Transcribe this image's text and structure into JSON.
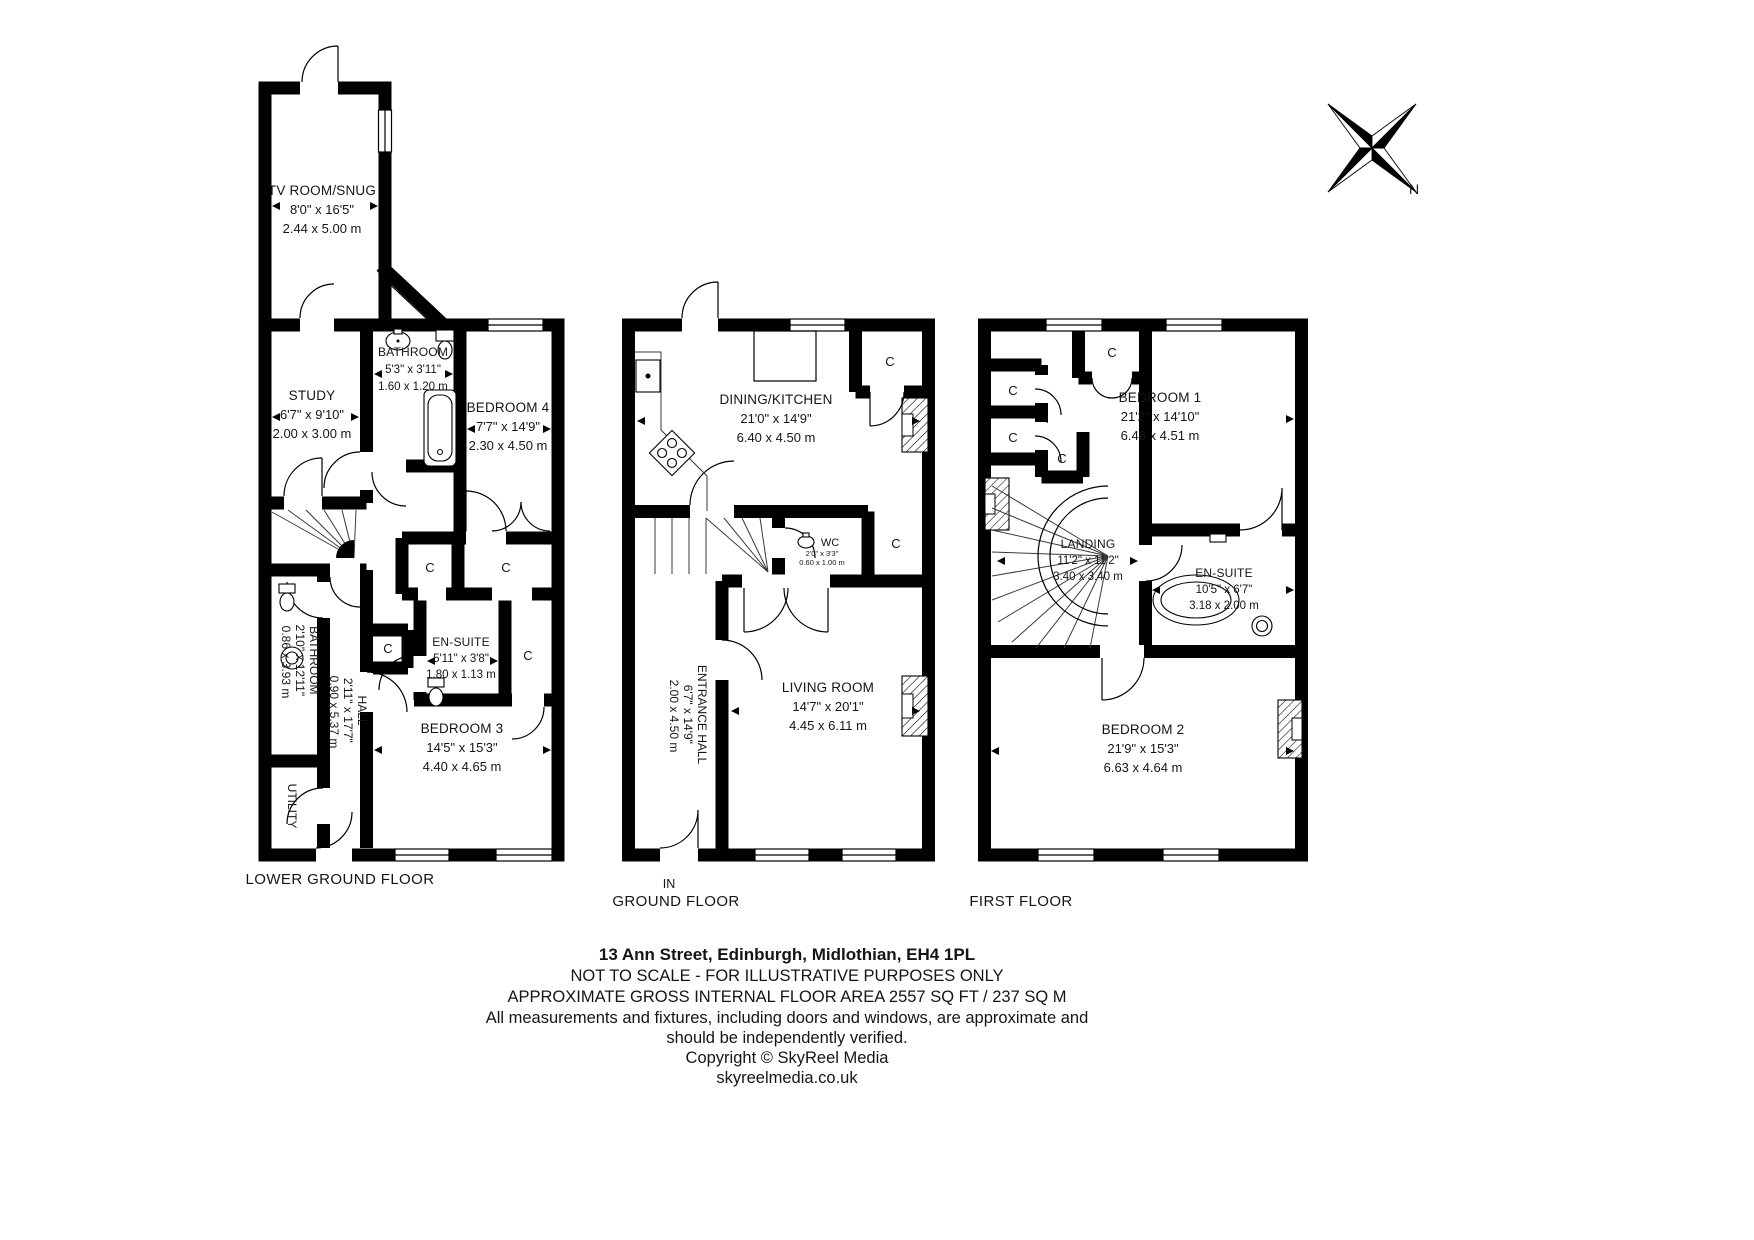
{
  "labels": {
    "closet": "C",
    "in": "IN",
    "north": "N"
  },
  "floors": {
    "lower": {
      "title": "LOWER GROUND FLOOR",
      "rooms": {
        "tv": {
          "name": "TV ROOM/SNUG",
          "imperial": "8'0\" x 16'5\"",
          "metric": "2.44 x 5.00 m"
        },
        "study": {
          "name": "STUDY",
          "imperial": "6'7\" x 9'10\"",
          "metric": "2.00 x 3.00 m"
        },
        "bathroom": {
          "name": "BATHROOM",
          "imperial": "5'3\" x 3'11\"",
          "metric": "1.60 x 1.20 m"
        },
        "bedroom4": {
          "name": "BEDROOM 4",
          "imperial": "7'7\" x 14'9\"",
          "metric": "2.30 x 4.50 m"
        },
        "ensuite": {
          "name": "EN-SUITE",
          "imperial": "5'11\" x 3'8\"",
          "metric": "1.80 x 1.13 m"
        },
        "bedroom3": {
          "name": "BEDROOM 3",
          "imperial": "14'5\" x 15'3\"",
          "metric": "4.40 x 4.65 m"
        },
        "side_bath": {
          "name": "BATHROOM",
          "imperial": "2'10\" x 12'11\"",
          "metric": "0.86 x 3.93 m"
        },
        "hall": {
          "name": "HALL",
          "imperial": "2'11\" x 17'7\"",
          "metric": "0.90 x 5.37 m"
        },
        "utility": {
          "name": "UTILITY"
        }
      }
    },
    "ground": {
      "title": "GROUND FLOOR",
      "rooms": {
        "dining": {
          "name": "DINING/KITCHEN",
          "imperial": "21'0\" x 14'9\"",
          "metric": "6.40 x 4.50 m"
        },
        "wc": {
          "name": "WC",
          "imperial": "2'0\" x 3'3\"",
          "metric": "0.60 x 1.00 m"
        },
        "living": {
          "name": "LIVING ROOM",
          "imperial": "14'7\" x 20'1\"",
          "metric": "4.45 x 6.11 m"
        },
        "entrance": {
          "name": "ENTRANCE HALL",
          "imperial": "6'7\" x 14'9\"",
          "metric": "2.00 x 4.50 m"
        }
      }
    },
    "first": {
      "title": "FIRST FLOOR",
      "rooms": {
        "bedroom1": {
          "name": "BEDROOM 1",
          "imperial": "21'2\" x 14'10\"",
          "metric": "6.46 x 4.51 m"
        },
        "landing": {
          "name": "LANDING",
          "imperial": "11'2\" x 11'2\"",
          "metric": "3.40 x 3.40 m"
        },
        "ensuite": {
          "name": "EN-SUITE",
          "imperial": "10'5\" x 6'7\"",
          "metric": "3.18 x 2.00 m"
        },
        "bedroom2": {
          "name": "BEDROOM 2",
          "imperial": "21'9\" x 15'3\"",
          "metric": "6.63 x 4.64 m"
        }
      }
    }
  },
  "footer": {
    "address": "13 Ann Street, Edinburgh, Midlothian, EH4 1PL",
    "scale_note": "NOT TO SCALE - FOR ILLUSTRATIVE PURPOSES ONLY",
    "area_note": "APPROXIMATE GROSS INTERNAL FLOOR AREA 2557 SQ FT / 237 SQ M",
    "disclaimer1": "All measurements and fixtures, including doors and windows, are approximate and",
    "disclaimer2": "should be independently verified.",
    "copyright": "Copyright © SkyReel Media",
    "website": "skyreelmedia.co.uk"
  }
}
